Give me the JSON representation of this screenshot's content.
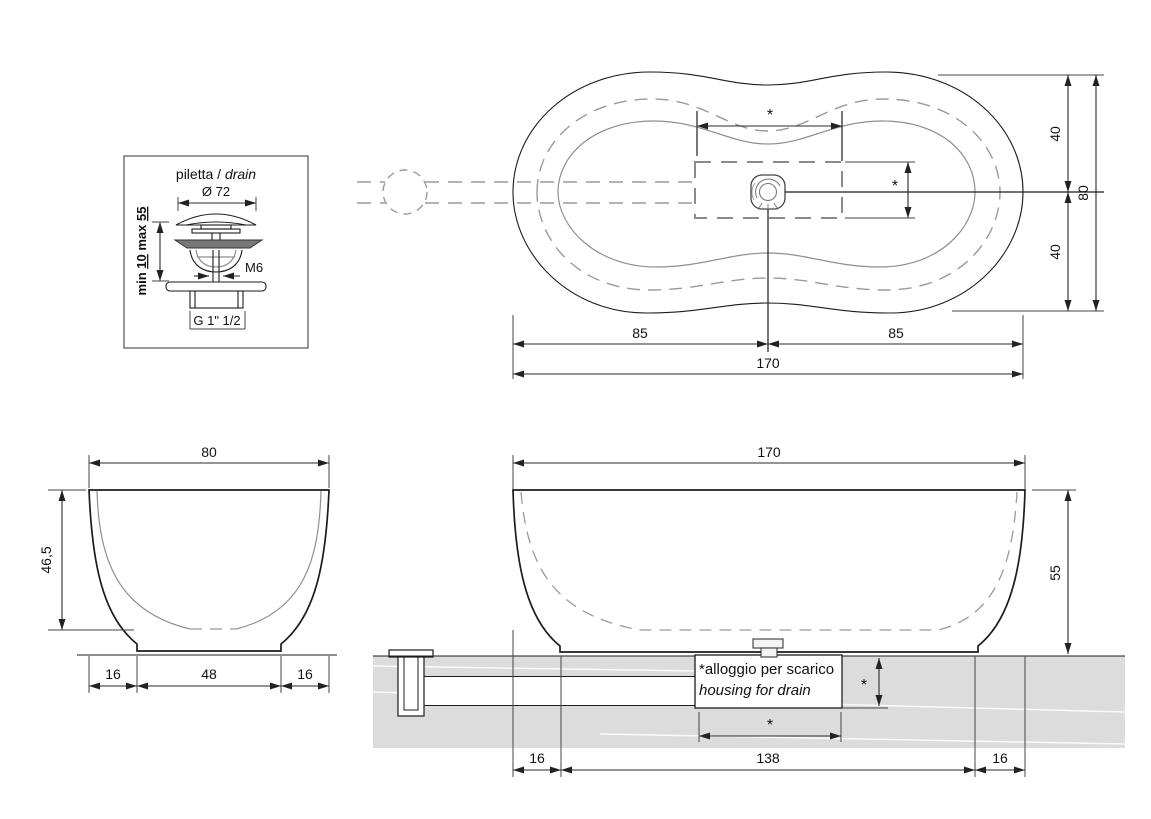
{
  "colors": {
    "background": "#ffffff",
    "line": "#1c1c1c",
    "gray_contour": "#8f8f8f",
    "slab_fill": "#dcdcdc"
  },
  "drain_detail": {
    "title_parts": [
      "piletta / ",
      "drain"
    ],
    "diameter": "Ø 72",
    "range_parts": [
      "min ",
      "10",
      " max ",
      "55"
    ],
    "thread": "M6",
    "connection": "G 1\" 1/2"
  },
  "top_view": {
    "half_left": "85",
    "half_right": "85",
    "total_length": "170",
    "upper_half": "40",
    "lower_half": "40",
    "total_width": "80",
    "housing_length": "*",
    "housing_width": "*"
  },
  "end_view": {
    "width": "80",
    "height": "46,5",
    "left_margin": "16",
    "base": "48",
    "right_margin": "16"
  },
  "side_view": {
    "length": "170",
    "height": "55",
    "left_margin": "16",
    "base": "138",
    "right_margin": "16",
    "housing_depth": "*",
    "housing_length": "*",
    "note_line1": "*alloggio per scarico",
    "note_line2": "housing for drain"
  }
}
